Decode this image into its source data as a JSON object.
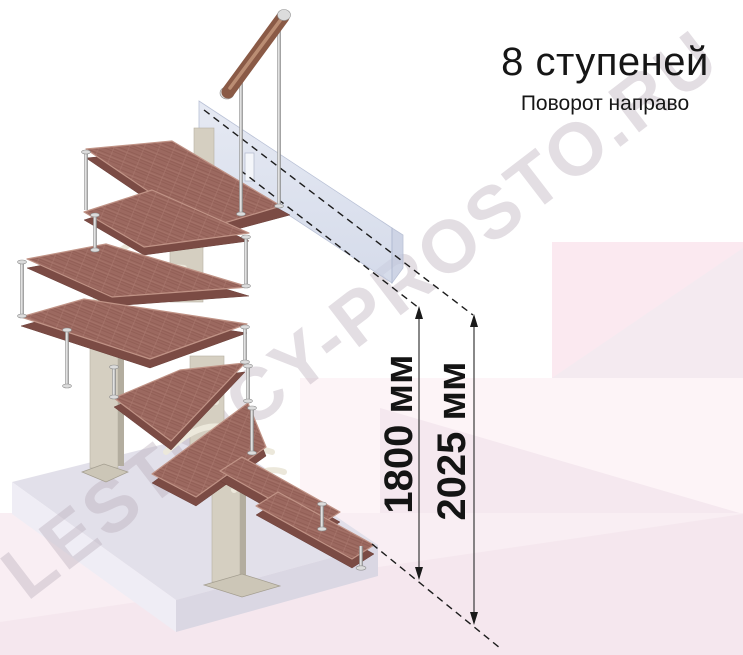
{
  "header": {
    "title": "8 ступеней",
    "subtitle": "Поворот направо"
  },
  "dimensions": {
    "to_ceiling": "1800 мм",
    "total": "2025 мм"
  },
  "watermark": {
    "text": "LESTNICY-PROSTO.RU"
  },
  "colors": {
    "wood": "#9c6960",
    "support": "#d5cfc1",
    "wall_accent": "#fbe9f0",
    "platform": "#e2e0ea"
  }
}
